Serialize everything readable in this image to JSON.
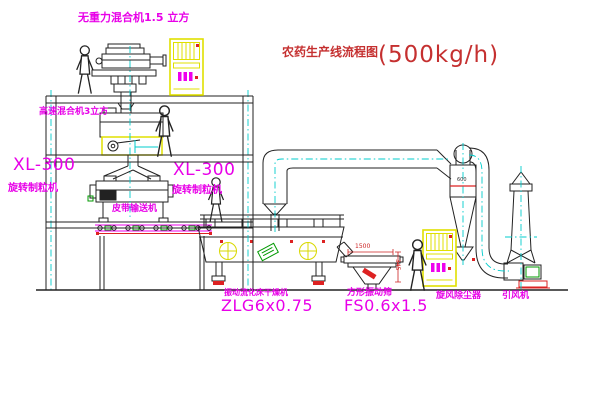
{
  "title": {
    "name": "农药生产线流程图",
    "capacity": "(500kg/h)"
  },
  "equipment_labels": {
    "gravity_free_mixer": "无重力混合机1.5 立方",
    "high_speed_mixer": "高速混合机3立方",
    "granulator_left": {
      "model": "XL-300",
      "name": "旋转制粒机"
    },
    "granulator_center": {
      "model": "XL-300",
      "name": "旋转制粒机"
    },
    "belt_conveyor": "皮带输送机",
    "dryer": {
      "name": "振动流化床干燥机",
      "model": "ZLG6x0.75"
    },
    "sieve": {
      "name": "方形振动筛",
      "model": "FS0.6x1.5"
    },
    "cyclone": "旋风除尘器",
    "fan": "引风机"
  },
  "dimensions": {
    "sieve_length": "1500",
    "sieve_height": "345",
    "cyclone_band": "600"
  },
  "colors": {
    "label_magenta": "#e800e8",
    "title_red": "#c53030",
    "line_black": "#222222",
    "centerline_cyan": "#00cccc",
    "cabinet_yellow": "#e0e000",
    "accent_red": "#dd2222",
    "accent_green": "#009900",
    "accent_yellow": "#d8d800"
  }
}
